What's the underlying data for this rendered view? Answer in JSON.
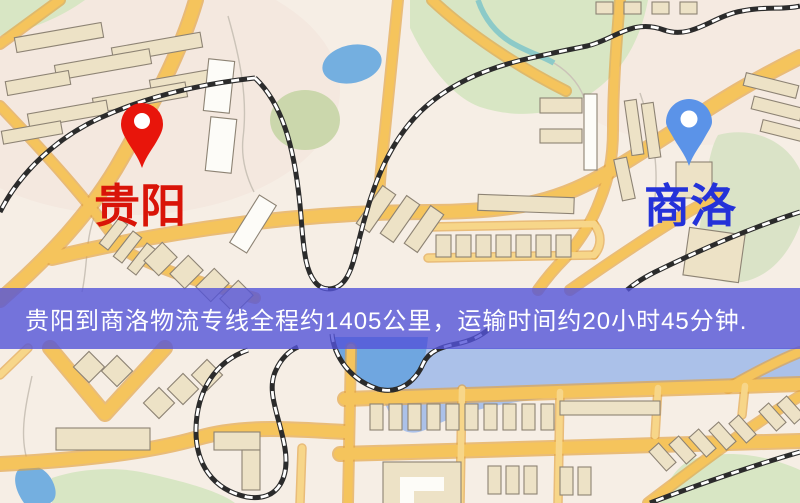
{
  "route_banner": {
    "text": "贵阳到商洛物流专线全程约1405公里，运输时间约20小时45分钟."
  },
  "markers": {
    "origin": {
      "label": "贵阳"
    },
    "destination": {
      "label": "商洛"
    }
  },
  "route_info": {
    "origin": "贵阳",
    "destination": "商洛",
    "distance_text": "约1405公里",
    "duration_text": "约20小时45分钟"
  },
  "icons": {
    "origin_pin": "map-pin-icon",
    "destination_pin": "map-pin-icon"
  },
  "colors": {
    "map_bg": "#f6eee5",
    "tint_pink": "#f2e0d8",
    "park": "#d8e6c4",
    "park_olive": "#cbd7ac",
    "park_sage": "#dae3c7",
    "water": "#74afe0",
    "water_band": "#9db9ea",
    "water_deep": "#6fa6e0",
    "stream": "#8ccac8",
    "road": "#f5c45c",
    "road_casing": "#e2a23f",
    "road_minor": "#f7d689",
    "building": "#ede2c6",
    "building_white": "#fdfcf8",
    "building_stroke": "#8d8374",
    "contour": "#cbc3b8",
    "railway": "#2b2b2b",
    "railway_dash": "#ffffff",
    "banner_bg": "rgba(84,84,216,0.8)",
    "banner_text": "#ffffff",
    "origin_pin": "#e8150b",
    "origin_label": "#d91408",
    "destination_pin": "#5b93e8",
    "destination_label": "#2432d9",
    "pin_hole": "#ffffff"
  }
}
